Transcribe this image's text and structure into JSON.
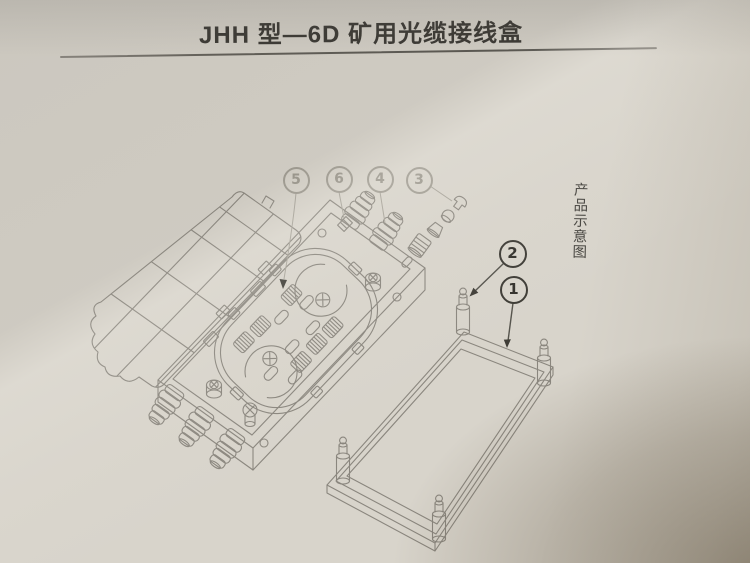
{
  "page": {
    "title": "JHH 型—6D 矿用光缆接线盒",
    "side_caption": "产品示意图"
  },
  "diagram": {
    "callouts": [
      {
        "label": "5",
        "style": "light"
      },
      {
        "label": "6",
        "style": "light"
      },
      {
        "label": "4",
        "style": "light"
      },
      {
        "label": "3",
        "style": "light"
      },
      {
        "label": "2",
        "style": "dark"
      },
      {
        "label": "1",
        "style": "dark"
      }
    ]
  },
  "colors": {
    "paper": "#d8d4cb",
    "paper_shadow_corner": "#a89e8e",
    "title_ink": "#34322d",
    "line_art": "#8a867e",
    "callout_light": "#a19d93",
    "callout_dark": "#3d3b35"
  }
}
